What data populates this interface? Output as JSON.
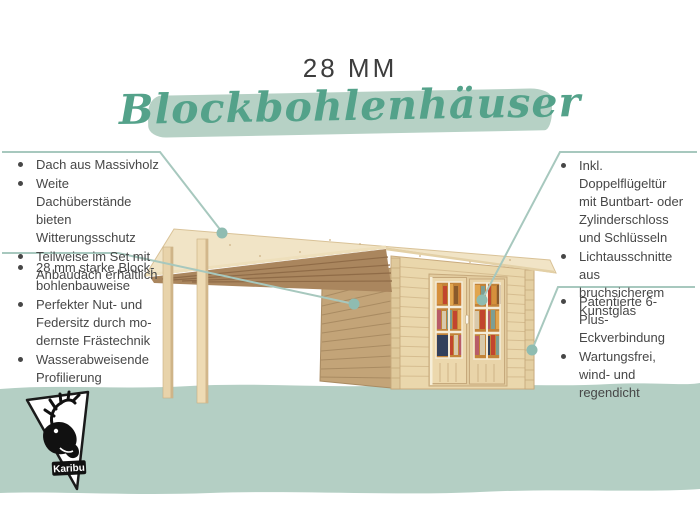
{
  "title": "28 MM",
  "heading": "Blockbohlenhäuser",
  "features": {
    "left_top": [
      "Dach aus Massivholz",
      "Weite Dachüberstände bieten Witterungsschutz",
      "Teilweise im Set mit Anbaudach erhältlich"
    ],
    "left_bottom": [
      "28 mm starke Block­bohlenbauweise",
      "Perfekter Nut- und Federsitz durch mo­dernste Frästechnik",
      "Wasserabweisende Profilierung"
    ],
    "right_top": [
      "Inkl. Doppelflügeltür mit Buntbart- oder Zylinderschloss und Schlüsseln",
      "Lichtausschnitte aus bruchsicherem Kunst­glas"
    ],
    "right_bottom": [
      "Patentierte 6-Plus-Eckverbindung",
      "Wartungsfrei, wind- und regen­dicht"
    ]
  },
  "logo": {
    "brand": "Karibu"
  },
  "colors": {
    "accent_script": "#54a28a",
    "heading_highlight": "#b6d1c5",
    "ground_band": "#b4cfc4",
    "callout_line": "#a7c8be",
    "callout_dot": "#8fbcb1",
    "text": "#474747",
    "wood_light": "#f1e4c6",
    "wood_shadow": "#aa865e"
  }
}
